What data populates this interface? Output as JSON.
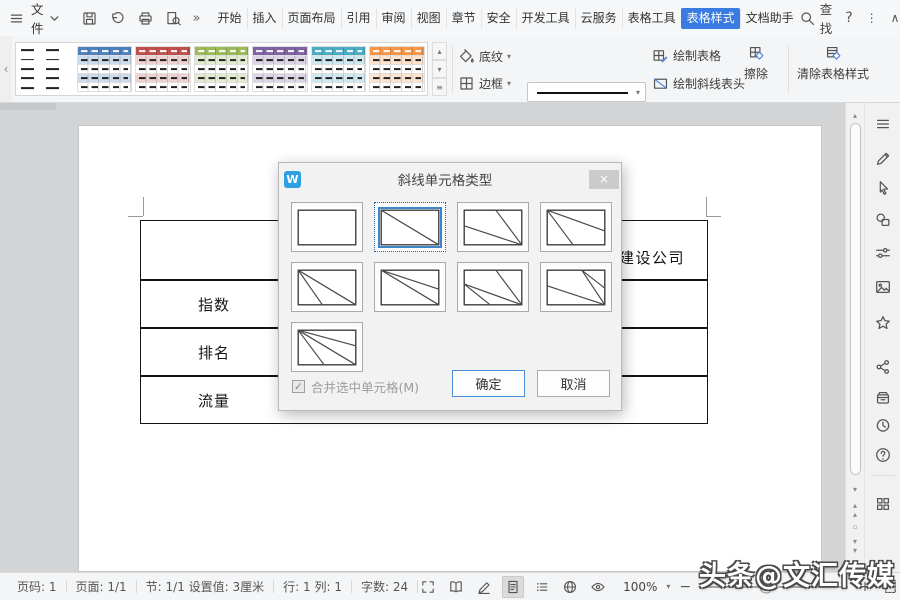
{
  "titlebar": {
    "file_label": "文件",
    "tabs": [
      "开始",
      "插入",
      "页面布局",
      "引用",
      "审阅",
      "视图",
      "章节",
      "安全",
      "开发工具",
      "云服务",
      "表格工具",
      "表格样式",
      "文档助手"
    ],
    "active_tab": "表格样式",
    "find_label": "查找",
    "accent_color": "#3a7be0"
  },
  "ribbon": {
    "gallery_styles": [
      {
        "name": "plain",
        "header": "",
        "tint": ""
      },
      {
        "name": "blue",
        "header": "#4f81bd",
        "tint": "#cfdcec"
      },
      {
        "name": "red",
        "header": "#c0504d",
        "tint": "#eed3d2"
      },
      {
        "name": "green",
        "header": "#9bbb59",
        "tint": "#e3ecd2"
      },
      {
        "name": "purple",
        "header": "#8064a2",
        "tint": "#ddd6e7"
      },
      {
        "name": "teal",
        "header": "#4bacc6",
        "tint": "#d0e8f0"
      },
      {
        "name": "orange",
        "header": "#f79646",
        "tint": "#fce4d1"
      }
    ],
    "shading_label": "底纹",
    "border_label": "边框",
    "line_width_value": "0.5",
    "line_width_unit": "磅",
    "draw_table_label": "绘制表格",
    "draw_diagonal_label": "绘制斜线表头",
    "erase_label": "擦除",
    "clear_style_label": "清除表格样式"
  },
  "dialog": {
    "title": "斜线单元格类型",
    "close_glyph": "×",
    "selected_index": 1,
    "options": [
      {
        "lines": []
      },
      {
        "lines": [
          [
            0,
            0,
            100,
            100
          ]
        ]
      },
      {
        "lines": [
          [
            55,
            0,
            100,
            100
          ],
          [
            0,
            45,
            100,
            100
          ]
        ]
      },
      {
        "lines": [
          [
            0,
            0,
            100,
            60
          ],
          [
            0,
            0,
            45,
            100
          ]
        ]
      },
      {
        "lines": [
          [
            0,
            0,
            42,
            100
          ],
          [
            0,
            0,
            100,
            100
          ]
        ]
      },
      {
        "lines": [
          [
            0,
            0,
            100,
            55
          ],
          [
            0,
            0,
            100,
            100
          ]
        ]
      },
      {
        "lines": [
          [
            55,
            0,
            100,
            100
          ],
          [
            0,
            40,
            100,
            100
          ],
          [
            0,
            40,
            45,
            100
          ]
        ]
      },
      {
        "lines": [
          [
            60,
            0,
            100,
            100
          ],
          [
            60,
            0,
            100,
            52
          ],
          [
            0,
            45,
            100,
            100
          ]
        ]
      },
      {
        "lines": [
          [
            0,
            0,
            100,
            45
          ],
          [
            0,
            0,
            100,
            100
          ],
          [
            0,
            0,
            45,
            100
          ]
        ]
      }
    ],
    "checkbox_label": "合并选中单元格(M)",
    "checkbox_checked": true,
    "check_glyph": "✓",
    "ok_label": "确定",
    "cancel_label": "取消"
  },
  "document": {
    "table_row_labels": [
      "指数",
      "排名",
      "流量"
    ],
    "clipped_cell_text": "建设公司"
  },
  "sidebar": {
    "tool_icons": [
      "hamburger-icon",
      "edit-pen-icon",
      "cursor-icon",
      "shapes-icon",
      "adjust-icon",
      "image-icon",
      "star-icon",
      "share-icon",
      "archive-icon",
      "history-icon",
      "help-icon",
      "apps-grid-icon"
    ]
  },
  "statusbar": {
    "segments": [
      "页码: 1",
      "页面: 1/1",
      "节: 1/1  设置值: 3厘米",
      "行: 1  列: 1",
      "字数: 24"
    ],
    "view_icons": [
      "fullscreen-icon",
      "read-mode-icon",
      "write-mode-icon",
      "page-view-icon",
      "outline-view-icon",
      "web-view-icon",
      "eye-protect-icon"
    ],
    "active_view_icon": "page-view-icon",
    "zoom_value": "100%"
  },
  "watermark": "头条@文汇传媒"
}
